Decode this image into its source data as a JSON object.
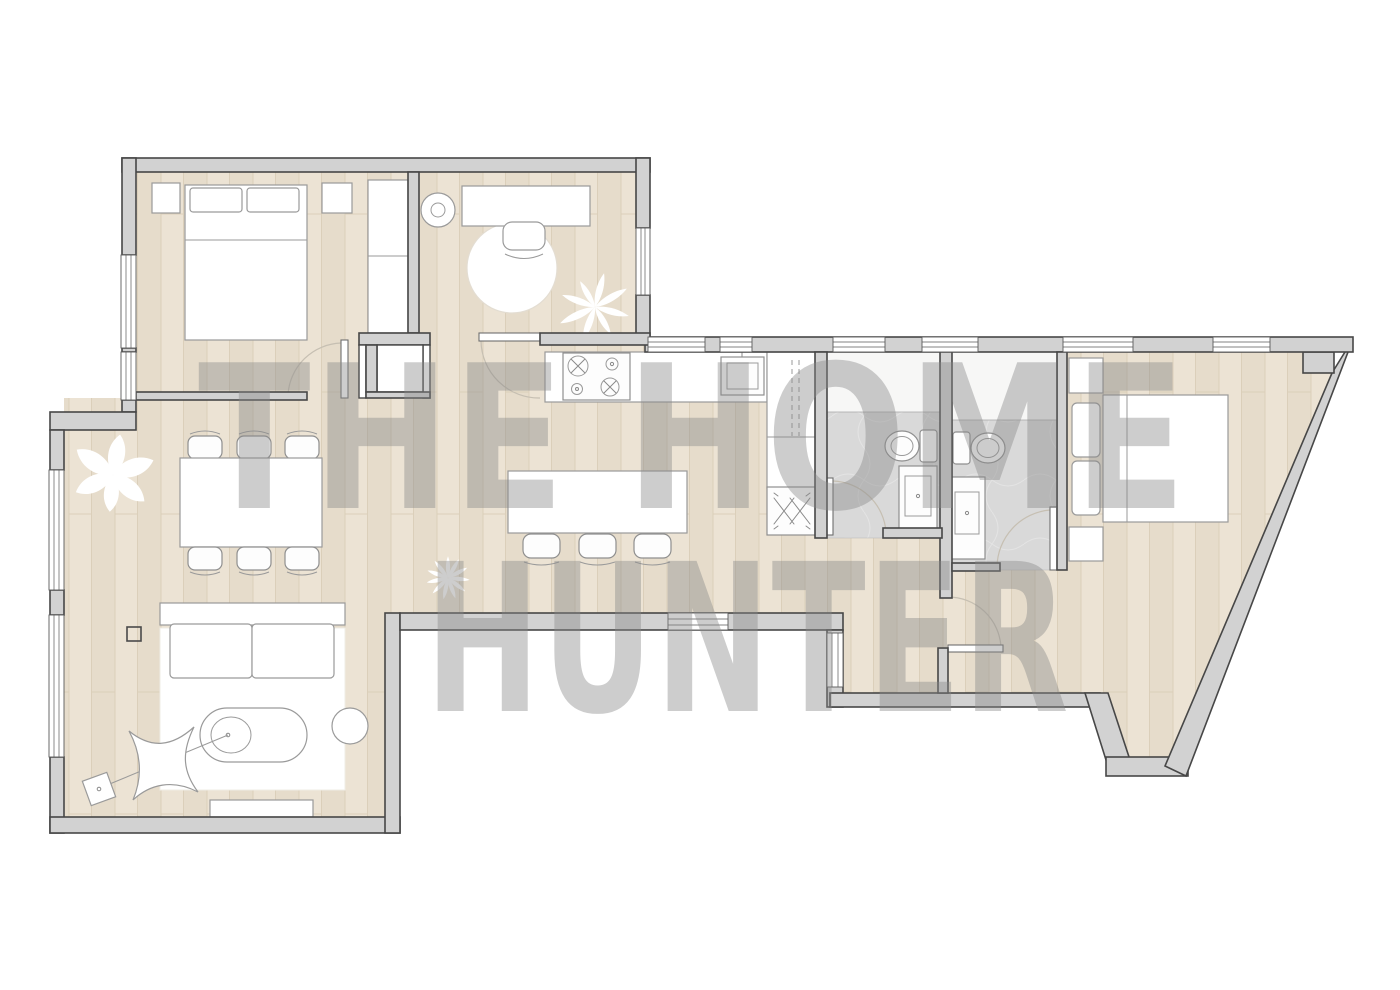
{
  "watermark": {
    "line1": "THE HOME",
    "line2": "HUNTER"
  },
  "palette": {
    "background": "#ffffff",
    "wall_fill": "#d2d2d2",
    "wall_outline": "#474747",
    "wood_base": "#ece3d4",
    "wood_streak": "#e6dccb",
    "wood_seam": "#dbcfba",
    "tile_fill": "#d9d9d9",
    "shower_fill": "#f7f7f6",
    "furniture_fill": "#ffffff",
    "furniture_outline": "#9a9a9a",
    "fixture_outline": "#8f8f8f",
    "door_arc": "#c6bfb2",
    "watermark_color": "#888888"
  },
  "plan": {
    "type": "apartment-floor-plan",
    "rooms": [
      {
        "id": "bedroom-1",
        "position": "top-left",
        "floor": "wood",
        "furniture": [
          "double-bed",
          "two-pillows",
          "nightstand-left",
          "nightstand-right",
          "wardrobe"
        ]
      },
      {
        "id": "office",
        "position": "top-middle",
        "floor": "wood",
        "furniture": [
          "desk",
          "desk-chair",
          "round-rug",
          "round-side-table",
          "plant"
        ]
      },
      {
        "id": "kitchen",
        "position": "middle",
        "floor": "wood",
        "furniture": [
          "counter-with-hob",
          "four-burner-hob",
          "sink",
          "tall-counter-dashed-appliance",
          "drying-rack",
          "island",
          "three-stools"
        ]
      },
      {
        "id": "dining-area",
        "position": "center-left",
        "floor": "wood",
        "furniture": [
          "dining-table",
          "six-chairs",
          "plant"
        ]
      },
      {
        "id": "living-room",
        "position": "bottom-left",
        "floor": "wood",
        "furniture": [
          "sofa",
          "area-rug",
          "oval-coffee-table",
          "floor-lamp",
          "lounge-chair",
          "round-side-table",
          "tv-console",
          "wall-column"
        ]
      },
      {
        "id": "bathroom-1",
        "position": "middle-right",
        "floor": "tile",
        "furniture": [
          "shower",
          "toilet",
          "vanity-sink"
        ]
      },
      {
        "id": "bathroom-2",
        "position": "middle-right",
        "floor": "tile",
        "furniture": [
          "shower",
          "toilet",
          "vanity-sink"
        ]
      },
      {
        "id": "bedroom-2",
        "position": "right",
        "floor": "wood",
        "furniture": [
          "double-bed",
          "two-pillows",
          "cabinet-top",
          "cabinet-bottom"
        ],
        "note": "diagonal exterior wall on right side"
      },
      {
        "id": "hallway",
        "position": "bottom-middle",
        "floor": "wood",
        "furniture": []
      }
    ],
    "doors": [
      "bedroom-1-door",
      "office-door",
      "bathroom-1-door",
      "bathroom-2-door",
      "bedroom-2-door"
    ],
    "window_count": 13
  }
}
